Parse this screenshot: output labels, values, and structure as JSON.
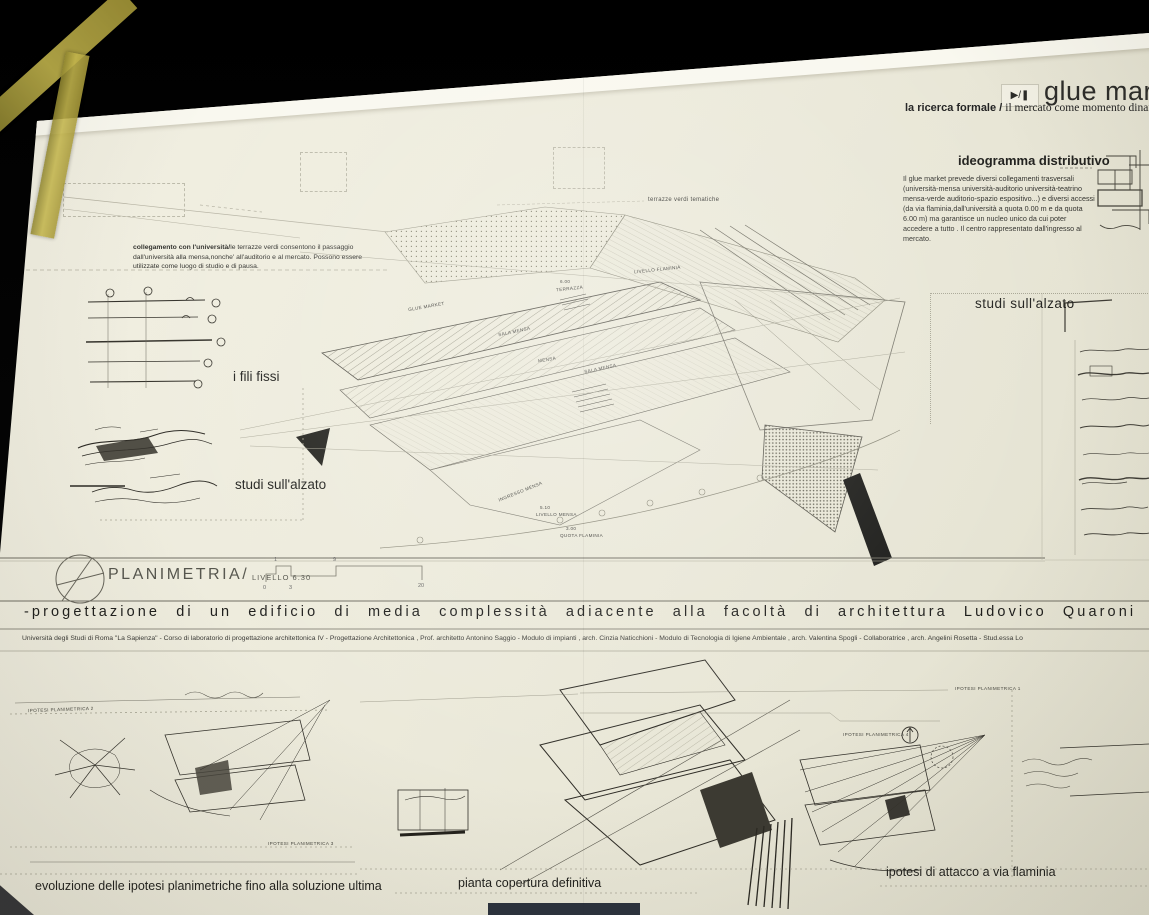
{
  "board": {
    "header": {
      "icon_play_pause": "▶/❚",
      "title": "glue market",
      "subtitle_bold": "la ricerca formale / ",
      "subtitle_rest": "il mercato come momento dinamico"
    },
    "ideogramma": {
      "heading": "ideogramma distributivo",
      "body": "Il glue market  prevede diversi collegamenti trasversali (università-mensa  università-auditorio  università-teatrino  mensa-verde  auditorio-spazio espositivo...) e diversi accessi (da via flaminia,dall'università a quota 0.00 m e da quota 6.00 m) ma garantisce un nucleo unico da cui poter accedere a tutto . Il centro rappresentato dall'ingresso al mercato."
    },
    "collegamento": {
      "lead": "collegamento con l'università/",
      "body": "le terrazze verdi consentono il passaggio dall'università alla mensa,nonche' all'auditorio e al mercato. Possono essere utilizzate come luogo di studio e di pausa."
    },
    "labels": {
      "fili_fissi": "i fili fissi",
      "studi_alzato_left": "studi sull'alzato",
      "studi_alzato_right": "studi  sull'alzato",
      "terrazze": "terrazze verdi tematiche"
    },
    "plan_labels": [
      "GLUE MARKET",
      "TERRAZZA",
      "LIVELLO FLAMINIA",
      "SALA MENSA",
      "MENSA",
      "SALA MENSA",
      "INGRESSO MENSA",
      "LIVELLO MENSA",
      "QUOTA FLAMINIA"
    ],
    "plan_quotas": [
      "6.00",
      "5.10",
      "3.00"
    ],
    "planimetria": {
      "title": "PLANIMETRIA/",
      "level": "LIVELLO 6.30",
      "scale_ticks": [
        "0",
        "1",
        "3",
        "9",
        "20"
      ]
    },
    "strip": {
      "title": "-progettazione di un edificio di media complessità adiacente alla facoltà di architettura Ludovico Quaroni",
      "credits": "Università degli Studi di Roma \"La Sapienza\"  -  Corso di laboratorio di progettazione architettonica IV   -  Progettazione Architettonica , Prof. architetto Antonino Saggio  -  Modulo di impianti ,  arch. Cinzia Naticchioni  -  Modulo di Tecnologia di Igiene Ambientale , arch. Valentina Spogli  -  Collaboratrice , arch. Angelini Rosetta -   Stud.essa Lo"
    },
    "bottom": {
      "ipotesi_1": "IPOTESI PLANIMETRICA 1",
      "ipotesi_2": "IPOTESI PLANIMETRICA 2",
      "ipotesi_3": "IPOTESI PLANIMETRICA 3",
      "ipotesi_4": "IPOTESI PLANIMETRICA 4",
      "caption_left": "evoluzione delle ipotesi planimetriche fino alla soluzione ultima",
      "caption_center": "pianta copertura definitiva",
      "caption_right": "ipotesi di attacco a via flaminia"
    },
    "colors": {
      "paper": "#edebdc",
      "ink": "#3a3a38",
      "tape": "#a89a3a",
      "background": "#060606"
    }
  }
}
